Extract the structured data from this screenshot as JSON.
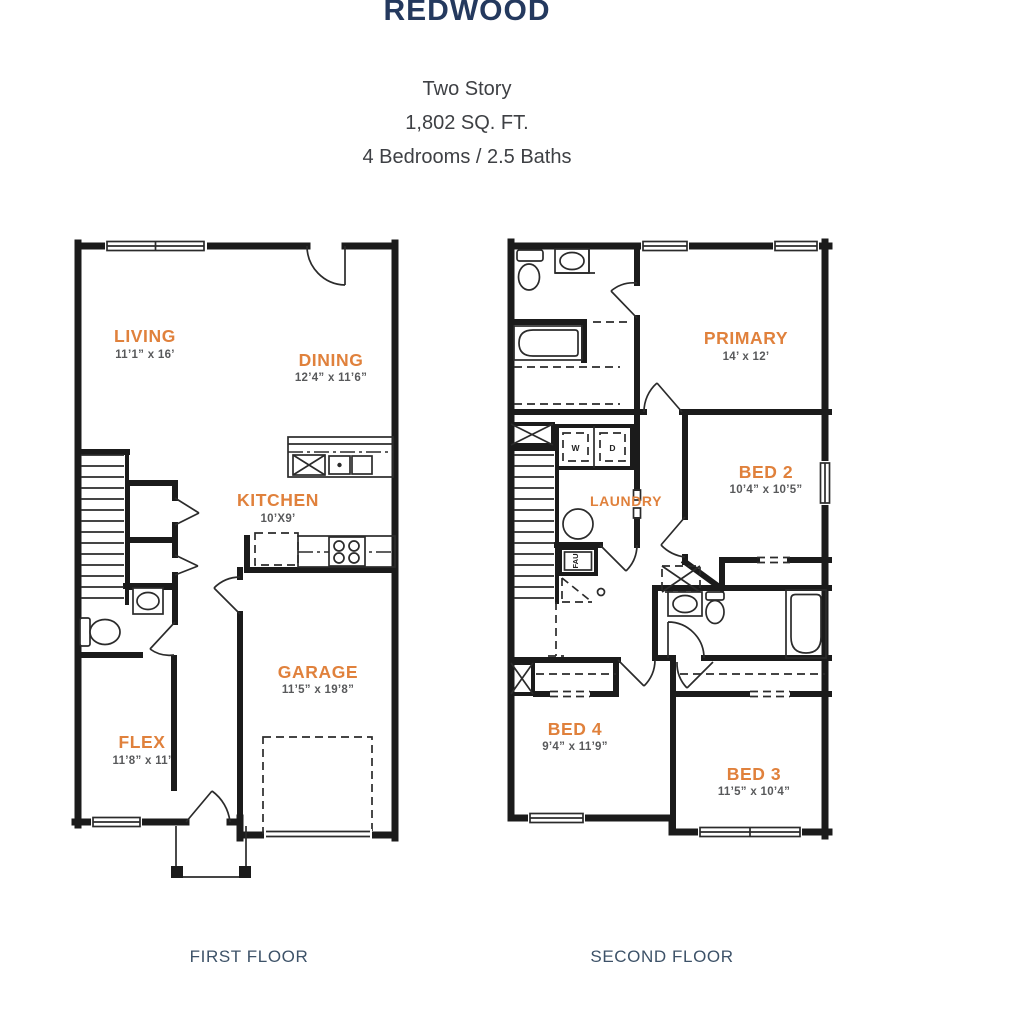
{
  "header": {
    "title": "REDWOOD",
    "line1": "Two Story",
    "line2": "1,802 SQ. FT.",
    "line3": "4 Bedrooms / 2.5 Baths"
  },
  "first_floor": {
    "caption": "FIRST FLOOR",
    "rooms": {
      "living": {
        "name": "LIVING",
        "dims": "11’1” x 16’"
      },
      "dining": {
        "name": "DINING",
        "dims": "12’4” x 11’6”"
      },
      "kitchen": {
        "name": "KITCHEN",
        "dims": "10’X9’"
      },
      "garage": {
        "name": "GARAGE",
        "dims": "11’5” x 19’8”"
      },
      "flex": {
        "name": "FLEX",
        "dims": "11’8” x 11’"
      }
    }
  },
  "second_floor": {
    "caption": "SECOND FLOOR",
    "rooms": {
      "primary": {
        "name": "PRIMARY",
        "dims": "14’ x 12’"
      },
      "bed2": {
        "name": "BED 2",
        "dims": "10’4” x 10’5”"
      },
      "laundry": {
        "name": "LAUNDRY"
      },
      "bed4": {
        "name": "BED 4",
        "dims": "9’4” x 11’9”"
      },
      "bed3": {
        "name": "BED 3",
        "dims": "11’5” x 10’4”"
      }
    },
    "appliances": {
      "washer": "W",
      "dryer": "D",
      "fau": "FAU"
    }
  },
  "colors": {
    "title_navy": "#24395E",
    "caption_navy": "#3D5268",
    "room_label_orange": "#E0813C",
    "dimension_gray": "#58595B",
    "wall_black": "#1B1B1B"
  }
}
